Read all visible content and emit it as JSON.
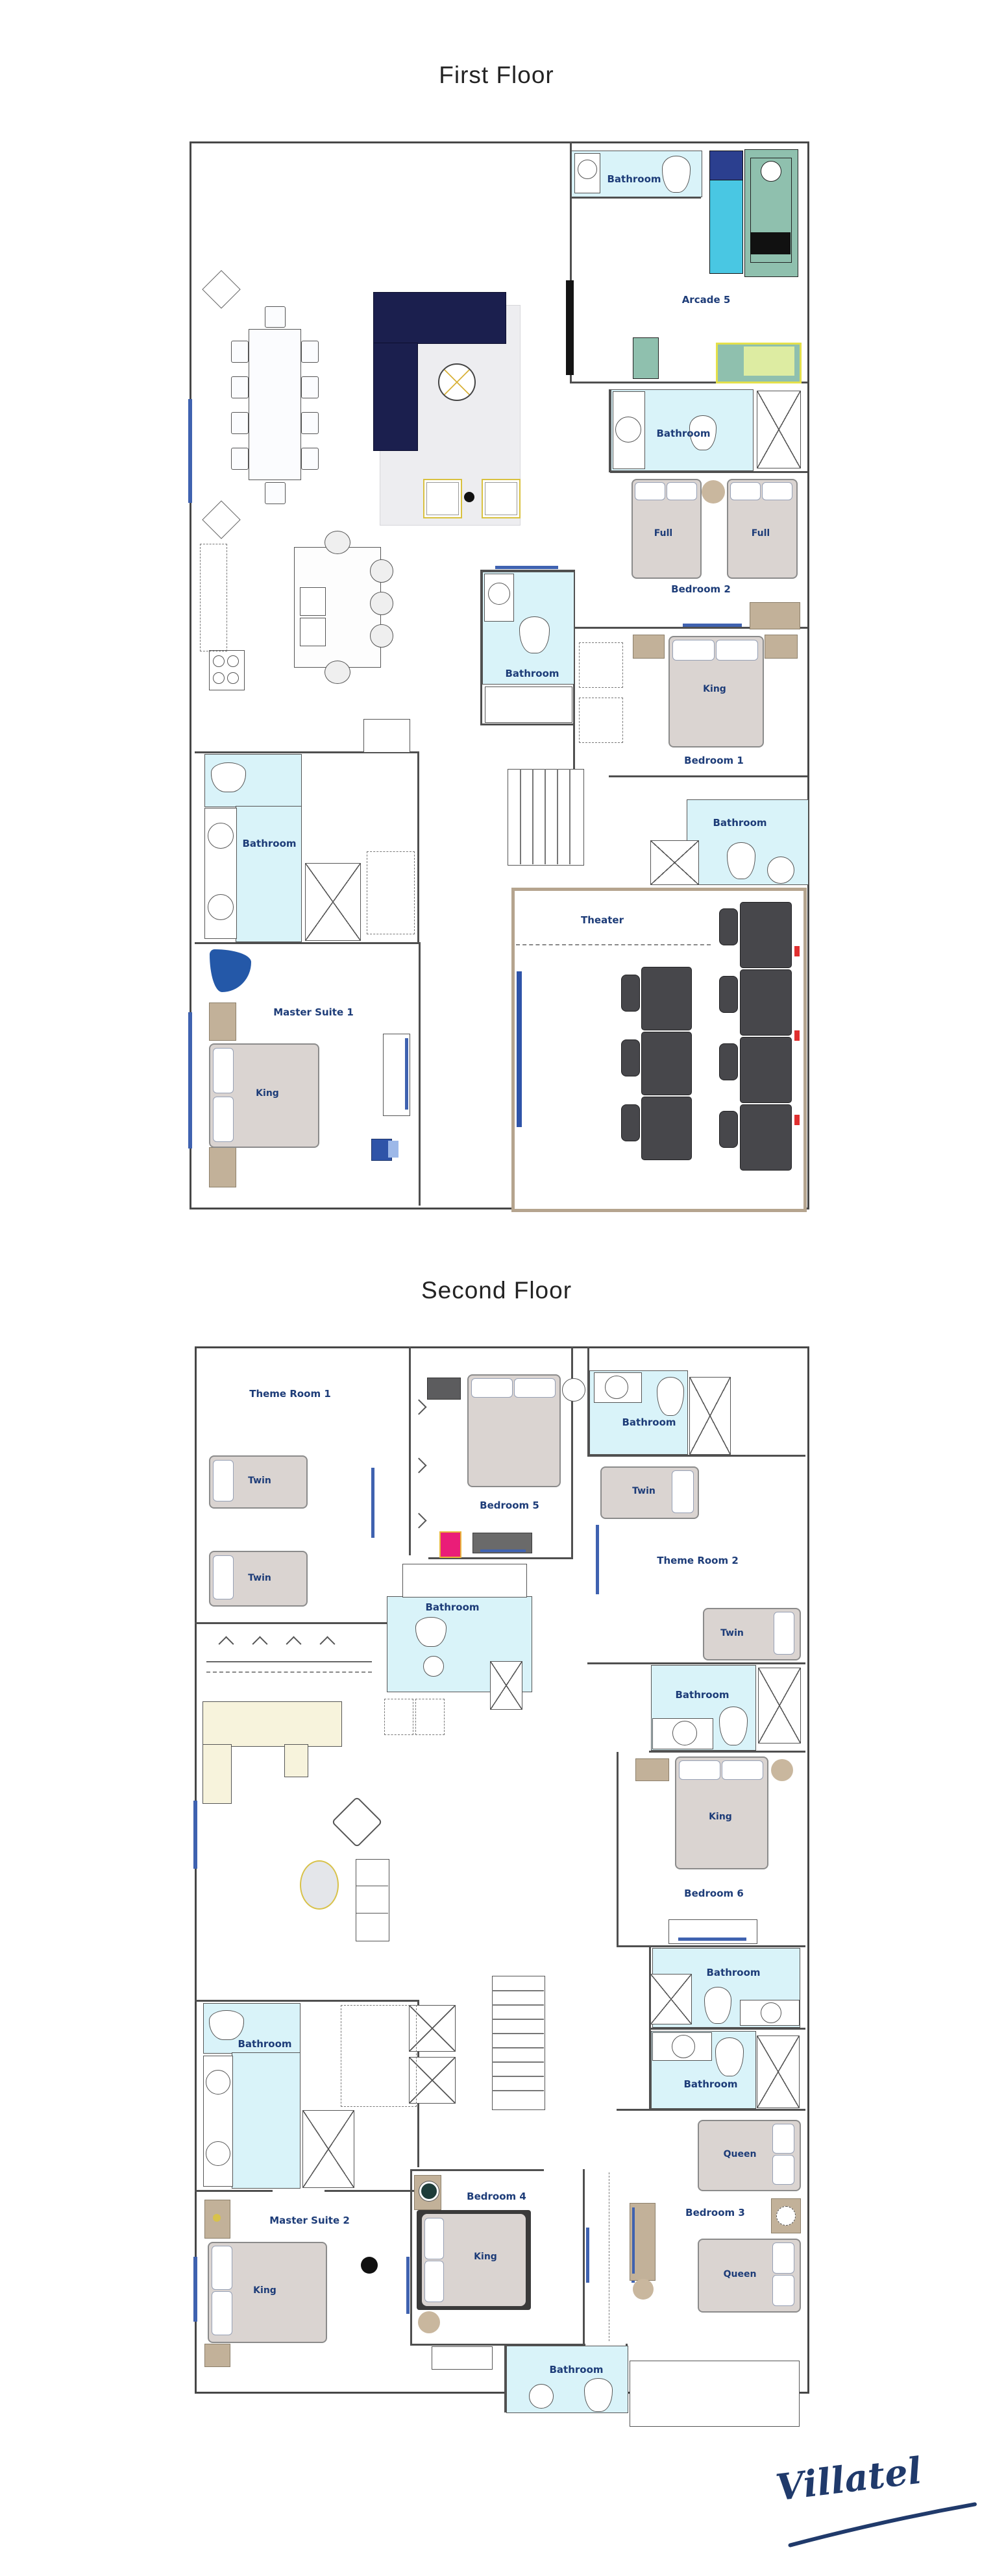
{
  "brand": {
    "logo_text": "Villatel"
  },
  "floors": [
    {
      "title": "First Floor",
      "room_labels": [
        "Bathroom",
        "Arcade 5",
        "Bathroom",
        "Bedroom 2",
        "Bathroom",
        "Bedroom 1",
        "Bathroom",
        "Bathroom",
        "Theater",
        "Master Suite 1"
      ],
      "bed_labels": [
        "Full",
        "Full",
        "King",
        "King"
      ]
    },
    {
      "title": "Second Floor",
      "room_labels": [
        "Theme Room 1",
        "Bathroom",
        "Bedroom 5",
        "Theme Room 2",
        "Bathroom",
        "Bathroom",
        "Bedroom 6",
        "Bathroom",
        "Bathroom",
        "Bathroom",
        "Master Suite 2",
        "Bedroom 4",
        "Bedroom 3",
        "Bathroom"
      ],
      "bed_labels": [
        "Twin",
        "Twin",
        "Twin",
        "Twin",
        "King",
        "Queen",
        "King",
        "King",
        "Queen"
      ]
    }
  ],
  "colors": {
    "label_navy": "#1d3c78",
    "bathroom_fill": "#d9f3f9",
    "bed_fill": "#dad4d1",
    "sofa_navy": "#1b1f4e",
    "theater_seat_gray": "#47474b",
    "theater_trim": "#b5a48e",
    "furniture_tan": "#c2b199",
    "window_blue": "#3f62b0",
    "arcade_teal": "#8fc0ae",
    "arcade_cyan": "#49c7e3",
    "arcade_dark_blue": "#2b3f8f",
    "game_pad_green": "#ddeca2",
    "magenta": "#ea1d78",
    "loft_cream": "#f7f3dc",
    "red_accent": "#e03030",
    "gold": "#d8c24a",
    "logo_navy": "#203a6b"
  }
}
